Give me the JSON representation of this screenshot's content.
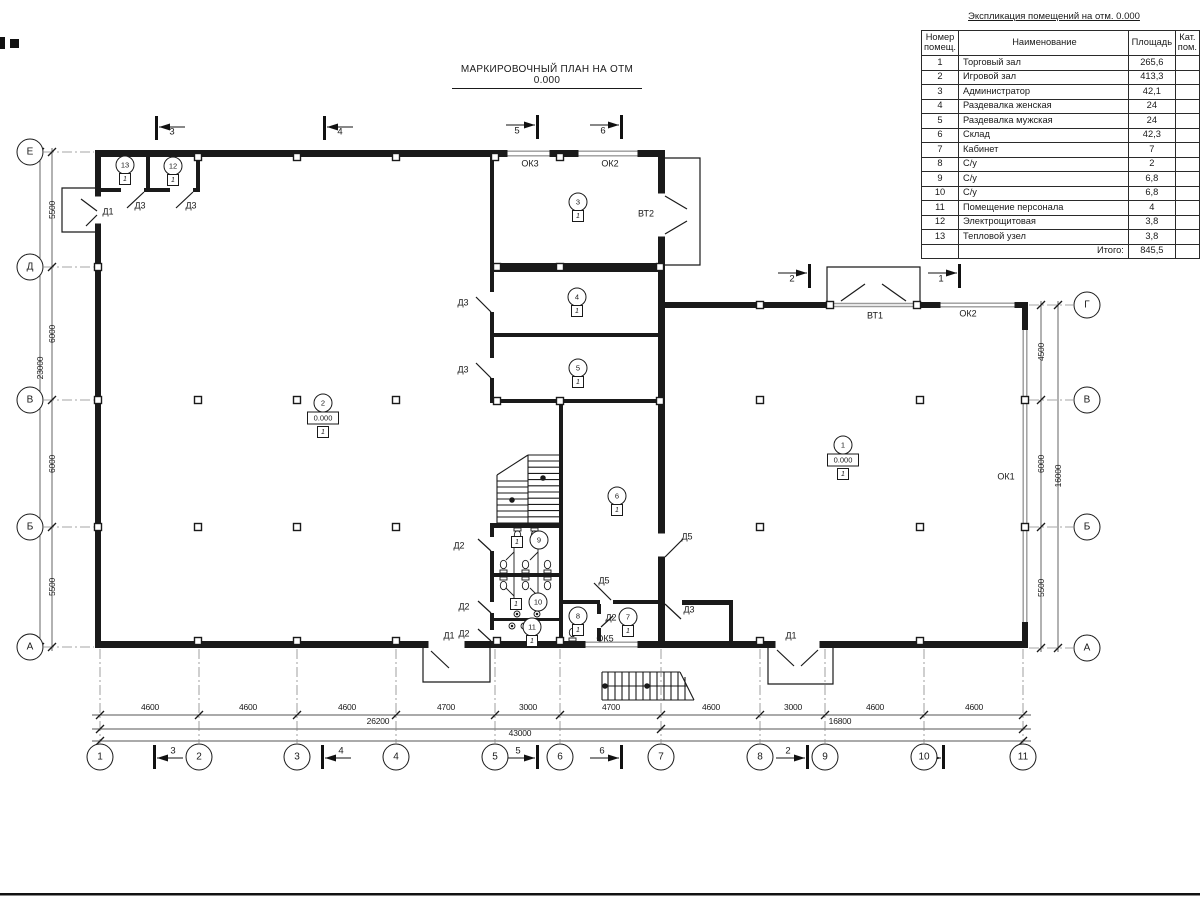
{
  "plan_title": "МАРКИРОВОЧНЫЙ ПЛАН НА ОТМ 0.000",
  "table": {
    "title": "Экспликация помещений на отм. 0.000",
    "headers": [
      "Номер помещ.",
      "Наименование",
      "Площадь",
      "Кат. пом."
    ],
    "rows": [
      [
        "1",
        "Торговый зал",
        "265,6",
        ""
      ],
      [
        "2",
        "Игровой зал",
        "413,3",
        ""
      ],
      [
        "3",
        "Администратор",
        "42,1",
        ""
      ],
      [
        "4",
        "Раздевалка женская",
        "24",
        ""
      ],
      [
        "5",
        "Раздевалка мужская",
        "24",
        ""
      ],
      [
        "6",
        "Склад",
        "42,3",
        ""
      ],
      [
        "7",
        "Кабинет",
        "7",
        ""
      ],
      [
        "8",
        "С/у",
        "2",
        ""
      ],
      [
        "9",
        "С/у",
        "6,8",
        ""
      ],
      [
        "10",
        "С/у",
        "6,8",
        ""
      ],
      [
        "11",
        "Помещение персонала",
        "4",
        ""
      ],
      [
        "12",
        "Электрощитовая",
        "3,8",
        ""
      ],
      [
        "13",
        "Тепловой узел",
        "3,8",
        ""
      ]
    ],
    "total_label": "Итого:",
    "total_value": "845,5"
  },
  "bubbles": [
    {
      "t": "1",
      "x": 100,
      "y": 757
    },
    {
      "t": "2",
      "x": 199,
      "y": 757
    },
    {
      "t": "3",
      "x": 297,
      "y": 757
    },
    {
      "t": "4",
      "x": 396,
      "y": 757
    },
    {
      "t": "5",
      "x": 495,
      "y": 757
    },
    {
      "t": "6",
      "x": 560,
      "y": 757
    },
    {
      "t": "7",
      "x": 661,
      "y": 757
    },
    {
      "t": "8",
      "x": 760,
      "y": 757
    },
    {
      "t": "9",
      "x": 825,
      "y": 757
    },
    {
      "t": "10",
      "x": 924,
      "y": 757
    },
    {
      "t": "11",
      "x": 1023,
      "y": 757
    },
    {
      "t": "Е",
      "x": 30,
      "y": 152
    },
    {
      "t": "Д",
      "x": 30,
      "y": 267
    },
    {
      "t": "В",
      "x": 30,
      "y": 400
    },
    {
      "t": "Б",
      "x": 30,
      "y": 527
    },
    {
      "t": "А",
      "x": 30,
      "y": 647
    },
    {
      "t": "Г",
      "x": 1087,
      "y": 305
    },
    {
      "t": "В",
      "x": 1087,
      "y": 400
    },
    {
      "t": "Б",
      "x": 1087,
      "y": 527
    },
    {
      "t": "А",
      "x": 1087,
      "y": 648
    }
  ],
  "labels": [
    {
      "t": "4600",
      "x": 150,
      "y": 707,
      "c": "dim"
    },
    {
      "t": "4600",
      "x": 248,
      "y": 707,
      "c": "dim"
    },
    {
      "t": "4600",
      "x": 347,
      "y": 707,
      "c": "dim"
    },
    {
      "t": "4700",
      "x": 446,
      "y": 707,
      "c": "dim"
    },
    {
      "t": "3000",
      "x": 528,
      "y": 707,
      "c": "dim"
    },
    {
      "t": "4700",
      "x": 611,
      "y": 707,
      "c": "dim"
    },
    {
      "t": "4600",
      "x": 711,
      "y": 707,
      "c": "dim"
    },
    {
      "t": "3000",
      "x": 793,
      "y": 707,
      "c": "dim"
    },
    {
      "t": "4600",
      "x": 875,
      "y": 707,
      "c": "dim"
    },
    {
      "t": "4600",
      "x": 974,
      "y": 707,
      "c": "dim"
    },
    {
      "t": "26200",
      "x": 378,
      "y": 721,
      "c": "dim"
    },
    {
      "t": "16800",
      "x": 840,
      "y": 721,
      "c": "dim"
    },
    {
      "t": "43000",
      "x": 520,
      "y": 733,
      "c": "dim"
    },
    {
      "t": "5500",
      "x": 52,
      "y": 210,
      "c": "dim rot"
    },
    {
      "t": "6000",
      "x": 52,
      "y": 334,
      "c": "dim rot"
    },
    {
      "t": "6000",
      "x": 52,
      "y": 464,
      "c": "dim rot"
    },
    {
      "t": "5500",
      "x": 52,
      "y": 587,
      "c": "dim rot"
    },
    {
      "t": "23000",
      "x": 40,
      "y": 368,
      "c": "dim rot"
    },
    {
      "t": "4500",
      "x": 1041,
      "y": 352,
      "c": "dim rot"
    },
    {
      "t": "6000",
      "x": 1041,
      "y": 464,
      "c": "dim rot"
    },
    {
      "t": "5500",
      "x": 1041,
      "y": 588,
      "c": "dim rot"
    },
    {
      "t": "16000",
      "x": 1058,
      "y": 476,
      "c": "dim rot"
    },
    {
      "t": "Д1",
      "x": 108,
      "y": 212,
      "c": "mark"
    },
    {
      "t": "Д3",
      "x": 140,
      "y": 206,
      "c": "mark"
    },
    {
      "t": "Д3",
      "x": 191,
      "y": 206,
      "c": "mark"
    },
    {
      "t": "ОК3",
      "x": 530,
      "y": 164,
      "c": "mark"
    },
    {
      "t": "ОК2",
      "x": 610,
      "y": 164,
      "c": "mark"
    },
    {
      "t": "ВТ2",
      "x": 646,
      "y": 214,
      "c": "mark"
    },
    {
      "t": "Д3",
      "x": 463,
      "y": 303,
      "c": "mark"
    },
    {
      "t": "Д3",
      "x": 463,
      "y": 370,
      "c": "mark"
    },
    {
      "t": "Д2",
      "x": 459,
      "y": 546,
      "c": "mark"
    },
    {
      "t": "Д2",
      "x": 464,
      "y": 607,
      "c": "mark"
    },
    {
      "t": "Д2",
      "x": 464,
      "y": 634,
      "c": "mark"
    },
    {
      "t": "Д5",
      "x": 604,
      "y": 581,
      "c": "mark"
    },
    {
      "t": "Д2",
      "x": 611,
      "y": 618,
      "c": "mark"
    },
    {
      "t": "Д3",
      "x": 689,
      "y": 610,
      "c": "mark"
    },
    {
      "t": "Д5",
      "x": 687,
      "y": 537,
      "c": "mark"
    },
    {
      "t": "Д1",
      "x": 449,
      "y": 636,
      "c": "mark"
    },
    {
      "t": "ОК5",
      "x": 605,
      "y": 639,
      "c": "mark"
    },
    {
      "t": "Д1",
      "x": 791,
      "y": 636,
      "c": "mark"
    },
    {
      "t": "ВТ1",
      "x": 875,
      "y": 316,
      "c": "mark"
    },
    {
      "t": "ОК2",
      "x": 968,
      "y": 314,
      "c": "mark"
    },
    {
      "t": "ОК1",
      "x": 1006,
      "y": 477,
      "c": "mark"
    },
    {
      "t": "3",
      "x": 172,
      "y": 132,
      "c": "sec"
    },
    {
      "t": "4",
      "x": 340,
      "y": 132,
      "c": "sec"
    },
    {
      "t": "5",
      "x": 517,
      "y": 131,
      "c": "sec"
    },
    {
      "t": "6",
      "x": 603,
      "y": 131,
      "c": "sec"
    },
    {
      "t": "2",
      "x": 792,
      "y": 279,
      "c": "sec"
    },
    {
      "t": "1",
      "x": 941,
      "y": 279,
      "c": "sec"
    },
    {
      "t": "3",
      "x": 173,
      "y": 751,
      "c": "sec"
    },
    {
      "t": "4",
      "x": 341,
      "y": 751,
      "c": "sec"
    },
    {
      "t": "5",
      "x": 518,
      "y": 751,
      "c": "sec"
    },
    {
      "t": "6",
      "x": 602,
      "y": 751,
      "c": "sec"
    },
    {
      "t": "2",
      "x": 788,
      "y": 751,
      "c": "sec"
    },
    {
      "t": "1",
      "x": 924,
      "y": 751,
      "c": "sec"
    }
  ],
  "rooms": [
    {
      "n": "1",
      "x": 843,
      "y": 445,
      "e": "0.000",
      "cat": "1"
    },
    {
      "n": "2",
      "x": 323,
      "y": 403,
      "e": "0.000",
      "cat": "1"
    },
    {
      "n": "3",
      "x": 578,
      "y": 202,
      "cat": "1"
    },
    {
      "n": "4",
      "x": 577,
      "y": 297,
      "cat": "1"
    },
    {
      "n": "5",
      "x": 578,
      "y": 368,
      "cat": "1"
    },
    {
      "n": "6",
      "x": 617,
      "y": 496,
      "cat": "1"
    },
    {
      "n": "7",
      "x": 628,
      "y": 617,
      "cat": "1"
    },
    {
      "n": "8",
      "x": 578,
      "y": 616,
      "cat": "1"
    },
    {
      "n": "9",
      "x": 539,
      "y": 540,
      "cat": "1",
      "side": "l"
    },
    {
      "n": "10",
      "x": 538,
      "y": 602,
      "cat": "1",
      "side": "l"
    },
    {
      "n": "11",
      "x": 532,
      "y": 627,
      "cat": "1"
    },
    {
      "n": "12",
      "x": 173,
      "y": 166,
      "cat": "1"
    },
    {
      "n": "13",
      "x": 125,
      "y": 165,
      "cat": "1"
    }
  ]
}
